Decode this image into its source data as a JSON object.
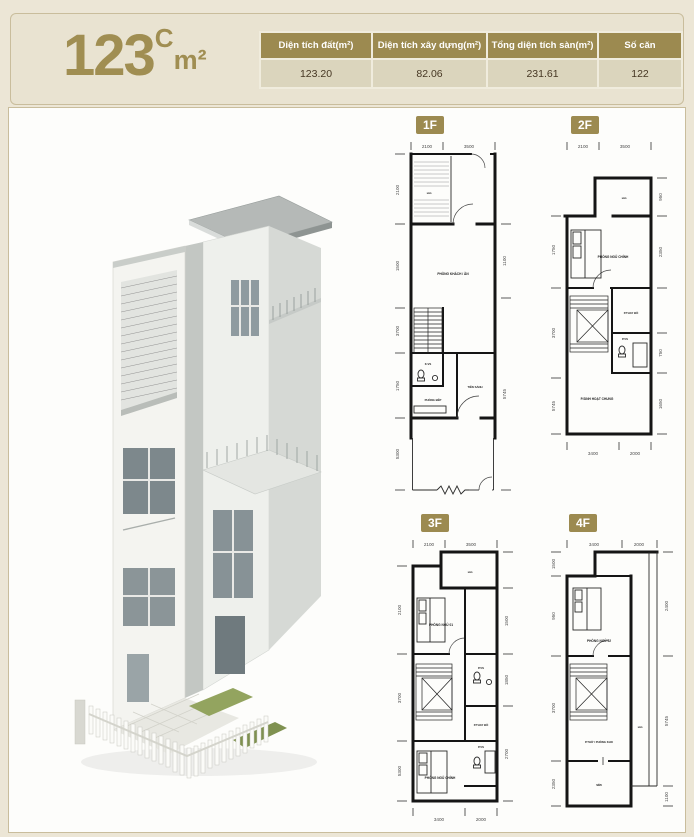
{
  "header": {
    "logo": {
      "number": "123",
      "variant": "C",
      "unit": "m²"
    },
    "table": {
      "columns": [
        "Diện tích đất(m²)",
        "Diện tích xây dựng(m²)",
        "Tổng diện tích sàn(m²)",
        "Số căn"
      ],
      "values": [
        "123.20",
        "82.06",
        "231.61",
        "122"
      ]
    }
  },
  "colors": {
    "accent_gold": "#9c8a50",
    "banner_bg": "#e9e3d1",
    "value_row_bg": "#dbd5bd"
  },
  "house": {
    "description": "3D rendering of a narrow 4-storey white townhouse with slanted roof, balconies and white picket fence"
  },
  "plans": {
    "f1": {
      "label": "1F",
      "dims_top": [
        "2100",
        "3500"
      ],
      "dims_left": [
        "2100",
        "1500",
        "3700",
        "1750",
        "5300"
      ],
      "dims_right": [
        "1100",
        "5745"
      ],
      "rooms": [
        "sân",
        "PHÒNG KHÁCH / ĂN",
        "K.VS",
        "PHÒNG BẾP",
        "TIỀN SẢNH"
      ]
    },
    "f2": {
      "label": "2F",
      "dims_top": [
        "2100",
        "3500"
      ],
      "dims_bottom": [
        "3400",
        "2000"
      ],
      "dims_left": [
        "1750",
        "3700",
        "5745"
      ],
      "dims_right": [
        "950",
        "2350",
        "750",
        "1650"
      ],
      "rooms": [
        "sân",
        "PHÒNG NGỦ CHÍNH",
        "P.THAY ĐỒ",
        "P.VS",
        "P.SINH HOẠT CHUNG"
      ]
    },
    "f3": {
      "label": "3F",
      "dims_top": [
        "2100",
        "3500"
      ],
      "dims_bottom": [
        "3400",
        "2000"
      ],
      "dims_left": [
        "2100",
        "3700",
        "5300"
      ],
      "dims_right": [
        "1500",
        "1850",
        "2700"
      ],
      "rooms": [
        "sân",
        "PHÒNG NGỦ 01",
        "P.VS",
        "P.THAY ĐỒ",
        "PHÒNG NGỦ CHÍNH",
        "P.VS"
      ]
    },
    "f4": {
      "label": "4F",
      "dims_top": [
        "3400",
        "2000"
      ],
      "dims_left": [
        "1500",
        "950",
        "3700",
        "2350"
      ],
      "dims_right": [
        "2400",
        "5745",
        "1100"
      ],
      "rooms": [
        "PHÒNG NGỦ 02",
        "sân",
        "P.THỜ / PHÒNG KHO",
        "sân"
      ]
    }
  }
}
